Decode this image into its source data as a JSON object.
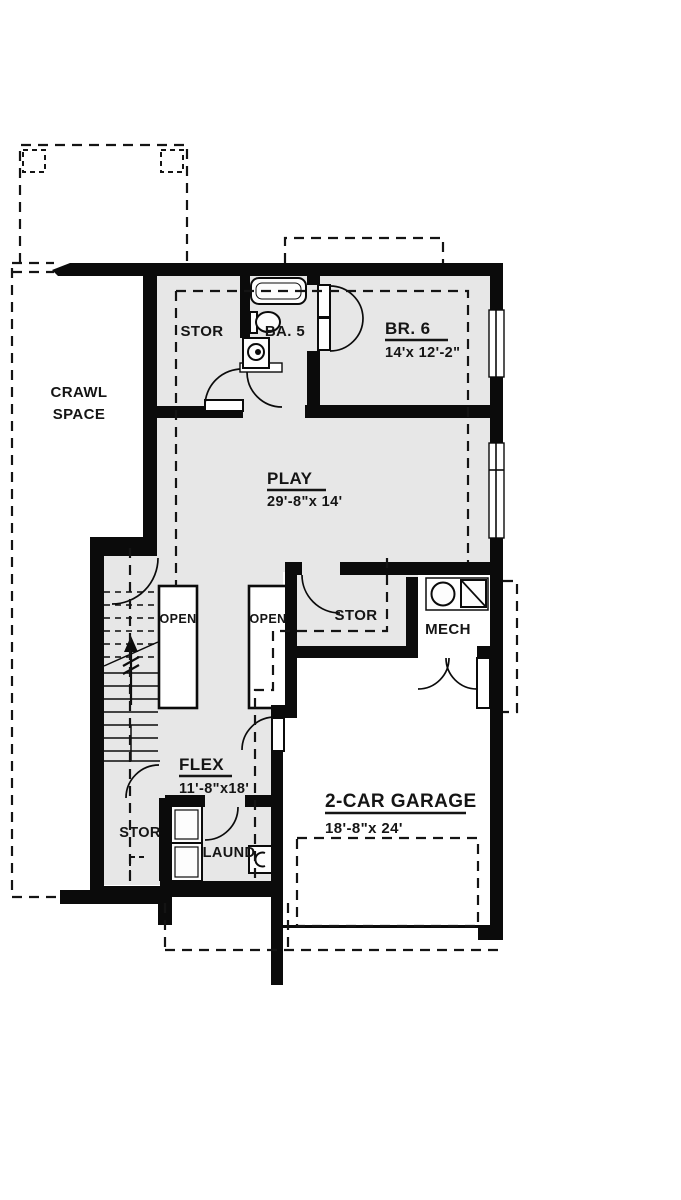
{
  "colors": {
    "wall": "#0b0b0b",
    "room_fill": "#e7e7e7",
    "background": "#ffffff"
  },
  "rooms": {
    "crawl_space": {
      "label_line1": "CRAWL",
      "label_line2": "SPACE"
    },
    "stor_top": {
      "label": "STOR"
    },
    "ba5": {
      "label": "BA. 5"
    },
    "br6": {
      "label": "BR. 6",
      "dims": "14'x 12'-2\""
    },
    "play": {
      "label": "PLAY",
      "dims": "29'-8\"x 14'"
    },
    "open_left": {
      "label": "OPEN"
    },
    "open_right": {
      "label": "OPEN"
    },
    "stor_mid": {
      "label": "STOR"
    },
    "mech": {
      "label": "MECH"
    },
    "flex": {
      "label": "FLEX",
      "dims": "11'-8\"x18'"
    },
    "stor_bottom": {
      "label": "STOR"
    },
    "laundry": {
      "label": "LAUND"
    },
    "garage": {
      "label": "2-CAR GARAGE",
      "dims": "18'-8\"x 24'"
    }
  }
}
